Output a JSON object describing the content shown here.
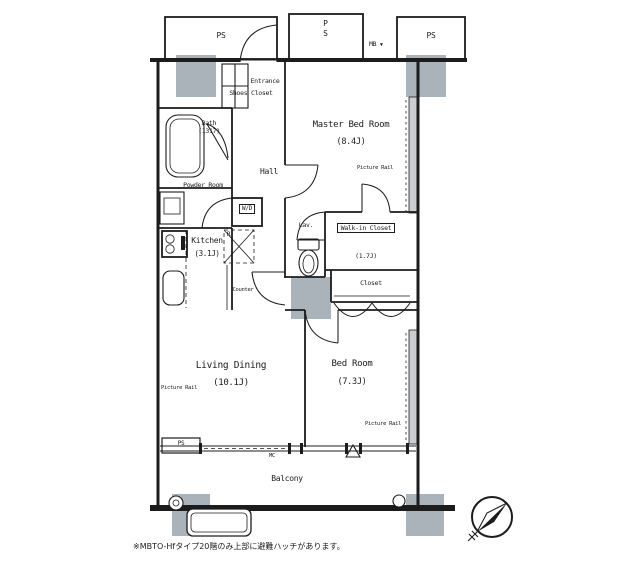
{
  "colors": {
    "line": "#1c1c1c",
    "pillar": "#a9b3b9",
    "window": "#c9ced2",
    "background": "#ffffff"
  },
  "shafts": {
    "top_left": "PS",
    "top_middle": "PS",
    "top_right": "PS",
    "bottom_left": "PS",
    "meter_box": "MB",
    "meter_box_icon": "▼"
  },
  "entrance": {
    "label": "Entrance",
    "shoes_closet": "Shoes Closet"
  },
  "rooms": {
    "master_bedroom": {
      "name": "Master Bed Room",
      "size": "(8.4J)"
    },
    "bedroom": {
      "name": "Bed Room",
      "size": "(7.3J)"
    },
    "living_dining": {
      "name": "Living Dining",
      "size": "(10.1J)"
    },
    "kitchen": {
      "name": "Kitchen",
      "size": "(3.1J)"
    },
    "bath": {
      "name": "Bath",
      "size": "(1317)"
    },
    "powder_room": {
      "name": "Powder Room"
    },
    "walk_in_closet": {
      "name": "Walk-in Closet",
      "size": "(1.7J)"
    },
    "closet": {
      "name": "Closet"
    },
    "hall": {
      "name": "Hall"
    },
    "lavatory": {
      "name": "Lav."
    },
    "balcony": {
      "name": "Balcony"
    }
  },
  "fixtures": {
    "washer_dryer": "W/D",
    "refrigerator": "R",
    "counter": "Counter",
    "picture_rail": "Picture Rail",
    "window_mark": "MC"
  },
  "footnote": "※MBTO-Hfタイプ20階のみ上部に避難ハッチがあります。"
}
